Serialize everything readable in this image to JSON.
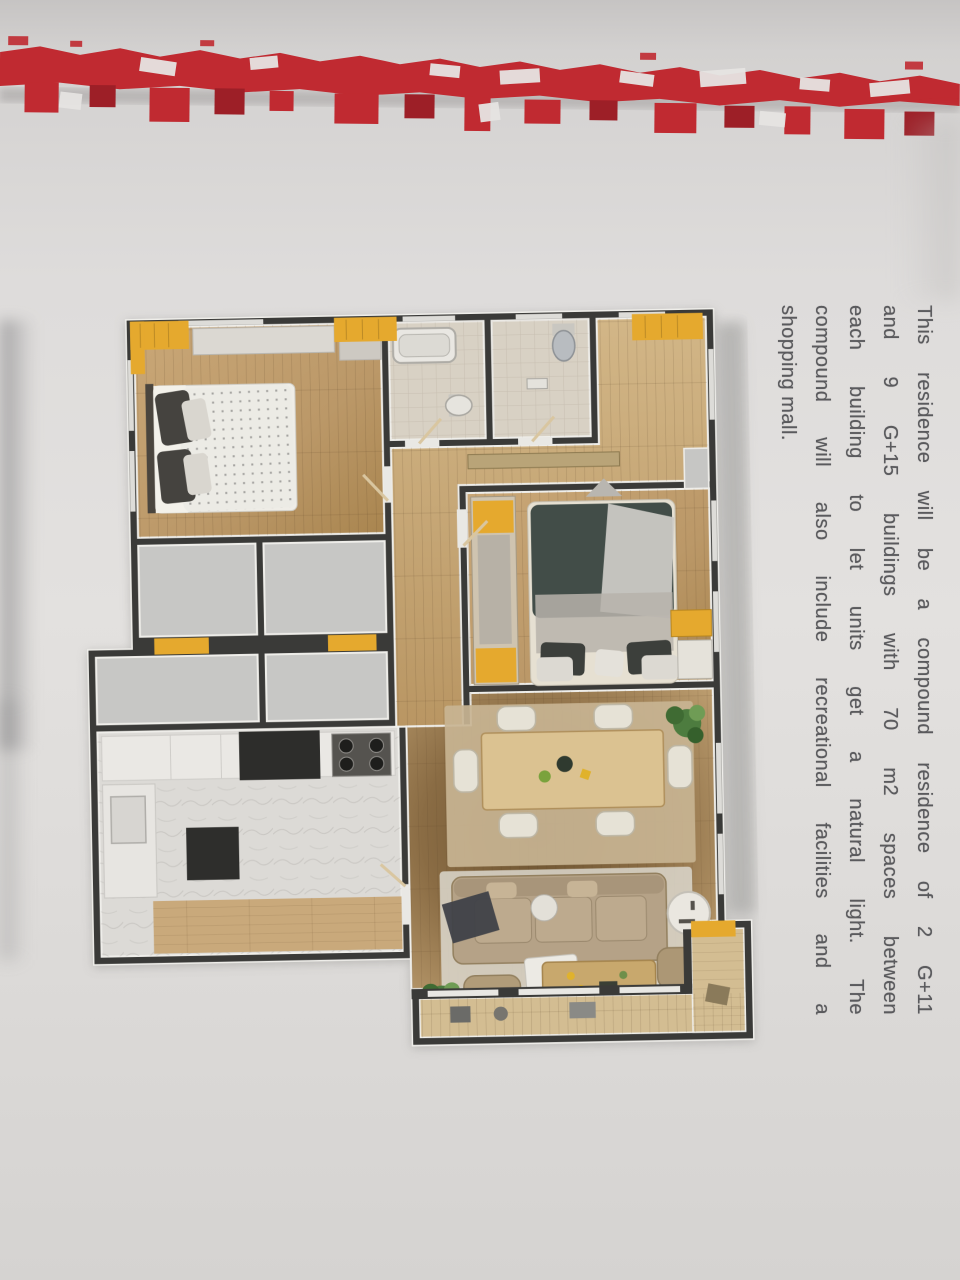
{
  "theme": {
    "paper": "#dcdad9",
    "paper_light": "#e6e4e2",
    "red_edge": "#c02a31",
    "red_edge_dark": "#9d1f27",
    "text_color": "#5a5a5d",
    "wall": "#3a3a38",
    "wood_light": "#cfb284",
    "wood_mid": "#c2a172",
    "wood_dark": "#6e5533",
    "tile": "#d8d1c4",
    "gray_room": "#c7c7c5",
    "kitchen_floor": "#dcdad6",
    "accent_yellow": "#e5a92e",
    "rug_beige": "#c8b493",
    "rug_cream": "#dad5ca",
    "sofa": "#b5a287",
    "duvet_dark": "#424d48",
    "plant_green": "#4d7c3f"
  },
  "paragraph": {
    "rotation": "90deg",
    "lines": [
      "This residence will be a compound residence of 2 G+11",
      "and 9 G+15 buildings with 70 m2 spaces between",
      "each building to let units get a natural light. The",
      "compound will also include recreational facilities and a",
      "shopping mall."
    ]
  },
  "floor_plan": {
    "rooms": [
      "bedroom-1",
      "bathroom-1",
      "bathroom-2",
      "foyer-hallway",
      "master-bedroom",
      "corridor",
      "storage-rooms",
      "kitchen",
      "living-dining-room",
      "balcony"
    ],
    "furniture": [
      "double-bed",
      "bathtub",
      "toilet",
      "wardrobe",
      "desk",
      "dining-table",
      "dining-chairs",
      "sofa",
      "coffee-table",
      "side-table",
      "pouffes",
      "stove",
      "gas-hob",
      "plants"
    ]
  }
}
